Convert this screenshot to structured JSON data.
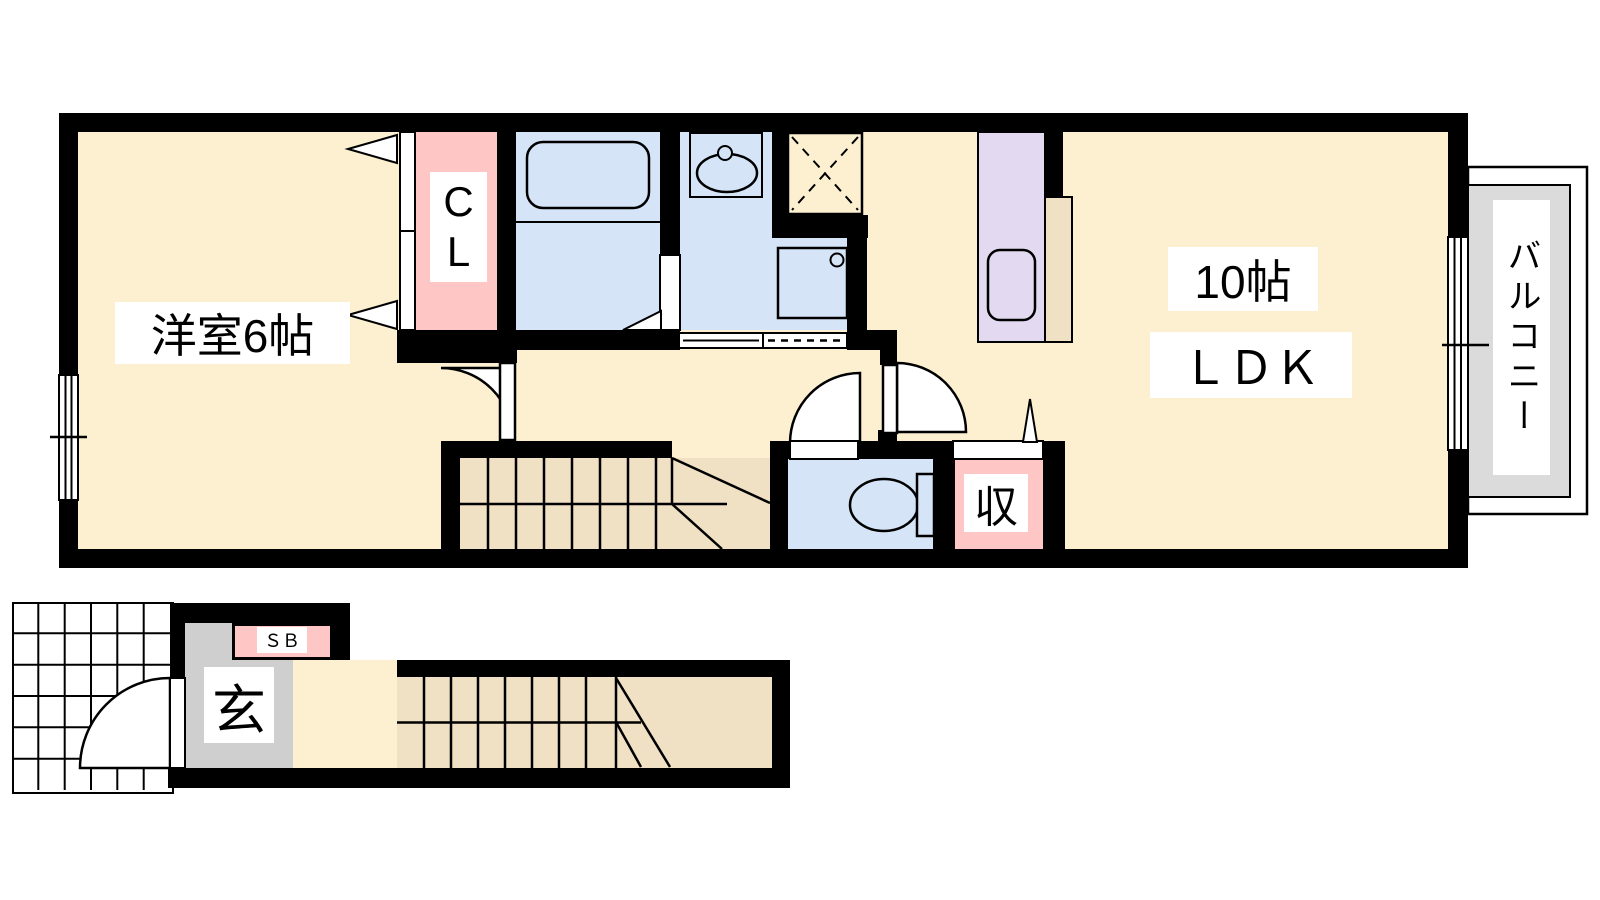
{
  "plan": {
    "type": "apartment-floor-plan",
    "unit_layout": "1LDK (2F maisonette with entrance stairs)",
    "labels": {
      "western_room": "洋室6帖",
      "closet": "C\nL",
      "ldk_size": "10帖",
      "ldk": "ＬＤＫ",
      "balcony": "バルコニー",
      "storage": "収",
      "entrance": "玄",
      "shoe_box": "ＳＢ"
    },
    "colors": {
      "floor": "#FCF0D0",
      "stairs": "#F0E1C5",
      "wet_area": "#D5E5F7",
      "closet_pink": "#FFC6C6",
      "kitchen": "#E3DAF2",
      "entrance_gray": "#CFCFCF",
      "balcony_gray": "#DBDBDB",
      "wall": "#000000",
      "background": "#FFFFFF"
    }
  }
}
